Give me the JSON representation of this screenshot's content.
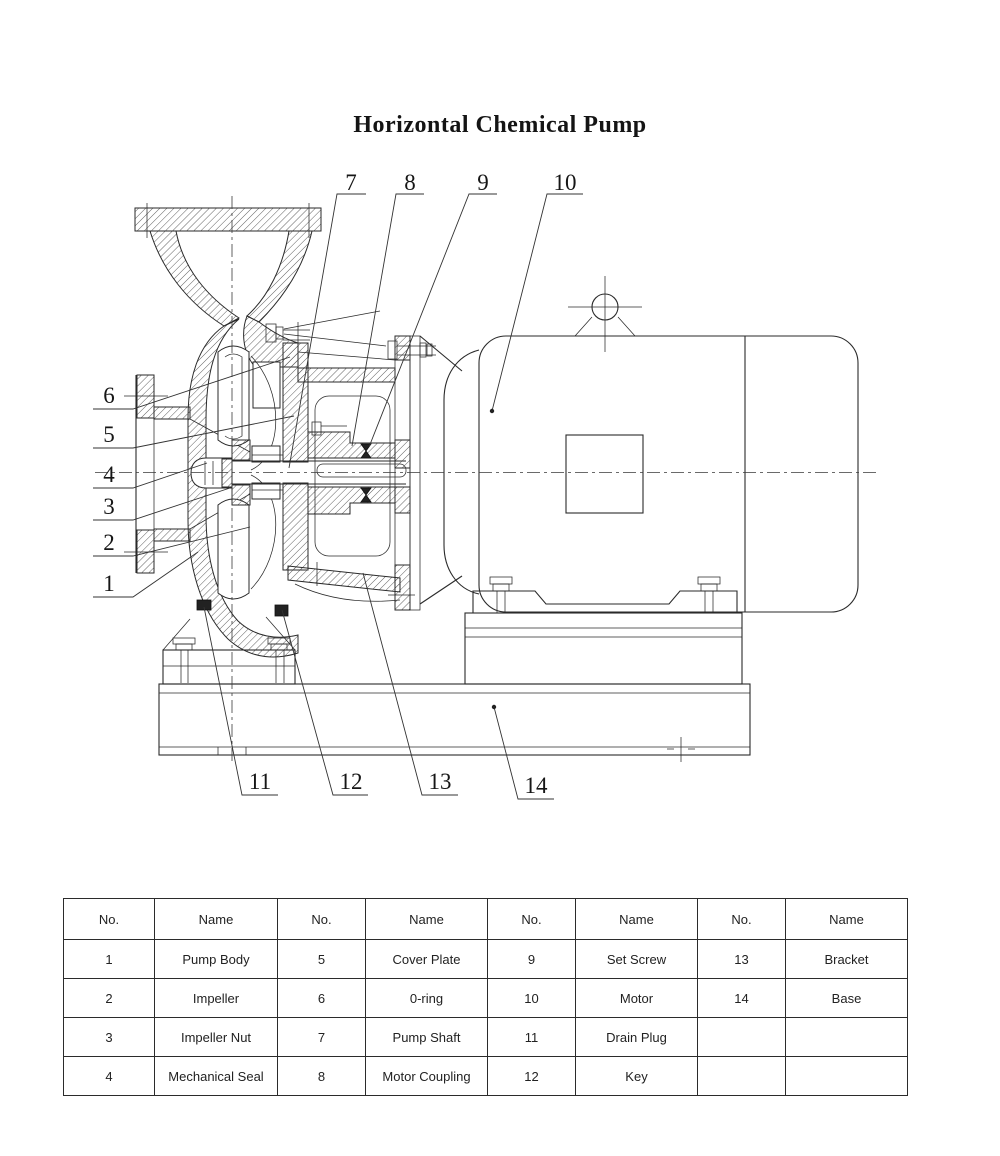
{
  "title": "Horizontal Chemical Pump",
  "diagram": {
    "callouts": [
      {
        "n": "7",
        "x": 351,
        "y": 190,
        "line": [
          [
            366,
            194
          ],
          [
            337,
            194
          ],
          [
            289,
            468
          ]
        ],
        "dot": false
      },
      {
        "n": "8",
        "x": 410,
        "y": 190,
        "line": [
          [
            424,
            194
          ],
          [
            396,
            194
          ],
          [
            352,
            446
          ]
        ],
        "dot": false
      },
      {
        "n": "9",
        "x": 483,
        "y": 190,
        "line": [
          [
            497,
            194
          ],
          [
            469,
            194
          ],
          [
            369,
            447
          ]
        ],
        "dot": false
      },
      {
        "n": "10",
        "x": 565,
        "y": 190,
        "line": [
          [
            583,
            194
          ],
          [
            547,
            194
          ],
          [
            492,
            411
          ]
        ],
        "dot": true
      },
      {
        "n": "6",
        "x": 109,
        "y": 403,
        "line": [
          [
            93,
            409
          ],
          [
            133,
            409
          ],
          [
            290,
            357
          ]
        ],
        "dot": false
      },
      {
        "n": "5",
        "x": 109,
        "y": 442,
        "line": [
          [
            93,
            448
          ],
          [
            133,
            448
          ],
          [
            294,
            416
          ]
        ],
        "dot": false
      },
      {
        "n": "4",
        "x": 109,
        "y": 482,
        "line": [
          [
            93,
            488
          ],
          [
            133,
            488
          ],
          [
            207,
            463
          ]
        ],
        "dot": false
      },
      {
        "n": "3",
        "x": 109,
        "y": 514,
        "line": [
          [
            93,
            520
          ],
          [
            133,
            520
          ],
          [
            230,
            488
          ]
        ],
        "dot": false
      },
      {
        "n": "2",
        "x": 109,
        "y": 550,
        "line": [
          [
            93,
            556
          ],
          [
            133,
            556
          ],
          [
            250,
            527
          ]
        ],
        "dot": false
      },
      {
        "n": "1",
        "x": 109,
        "y": 591,
        "line": [
          [
            93,
            597
          ],
          [
            133,
            597
          ],
          [
            198,
            552
          ]
        ],
        "dot": false
      },
      {
        "n": "11",
        "x": 260,
        "y": 789,
        "line": [
          [
            278,
            795
          ],
          [
            242,
            795
          ],
          [
            204,
            607
          ]
        ],
        "dot": false
      },
      {
        "n": "12",
        "x": 351,
        "y": 789,
        "line": [
          [
            368,
            795
          ],
          [
            333,
            795
          ],
          [
            282,
            610
          ]
        ],
        "dot": false
      },
      {
        "n": "13",
        "x": 440,
        "y": 789,
        "line": [
          [
            458,
            795
          ],
          [
            422,
            795
          ],
          [
            363,
            573
          ]
        ],
        "dot": false
      },
      {
        "n": "14",
        "x": 536,
        "y": 793,
        "line": [
          [
            554,
            799
          ],
          [
            518,
            799
          ],
          [
            494,
            707
          ]
        ],
        "dot": true
      }
    ]
  },
  "parts_table": {
    "headers": [
      "No.",
      "Name",
      "No.",
      "Name",
      "No.",
      "Name",
      "No.",
      "Name"
    ],
    "rows": [
      [
        "1",
        "Pump Body",
        "5",
        "Cover Plate",
        "9",
        "Set Screw",
        "13",
        "Bracket"
      ],
      [
        "2",
        "Impeller",
        "6",
        "0-ring",
        "10",
        "Motor",
        "14",
        "Base"
      ],
      [
        "3",
        "Impeller Nut",
        "7",
        "Pump Shaft",
        "11",
        "Drain Plug",
        "",
        ""
      ],
      [
        "4",
        "Mechanical Seal",
        "8",
        "Motor Coupling",
        "12",
        "Key",
        "",
        ""
      ]
    ]
  }
}
